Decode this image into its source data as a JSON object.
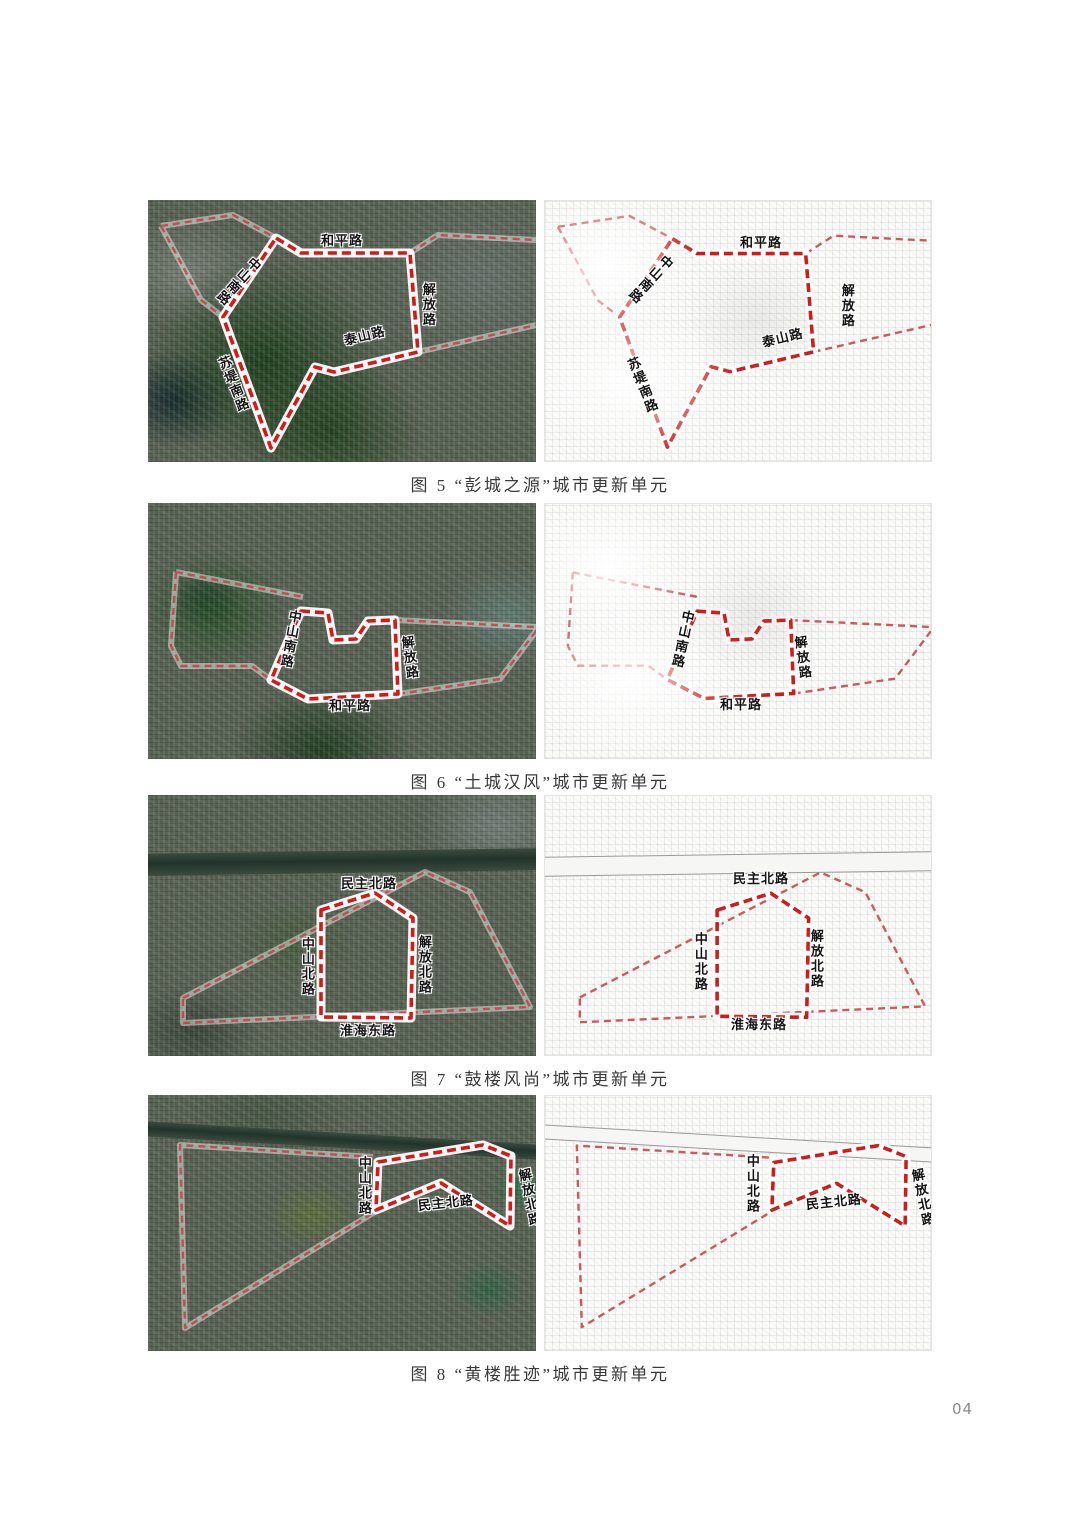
{
  "page": {
    "number": "04"
  },
  "style": {
    "unit_boundary_color": "#d51818",
    "outer_boundary_color": "#c24040",
    "road_label_color": "#141414"
  },
  "figures": [
    {
      "caption": "图 5 “彭城之源”城市更新单元",
      "unit_name": "彭城之源",
      "maps": [
        {
          "kind": "satellite",
          "roads": [
            "中山南路",
            "和平路",
            "解放路",
            "泰山路",
            "苏堤南路"
          ]
        },
        {
          "kind": "plan",
          "roads": [
            "中山南路",
            "和平路",
            "解放路",
            "泰山路",
            "苏堤南路"
          ]
        }
      ]
    },
    {
      "caption": "图 6 “土城汉风”城市更新单元",
      "unit_name": "土城汉风",
      "maps": [
        {
          "kind": "satellite",
          "roads": [
            "中山南路",
            "解放路",
            "和平路"
          ]
        },
        {
          "kind": "plan",
          "roads": [
            "中山南路",
            "解放路",
            "和平路"
          ]
        }
      ]
    },
    {
      "caption": "图 7 “鼓楼风尚”城市更新单元",
      "unit_name": "鼓楼风尚",
      "maps": [
        {
          "kind": "satellite",
          "roads": [
            "民主北路",
            "中山北路",
            "解放北路",
            "淮海东路"
          ]
        },
        {
          "kind": "plan",
          "roads": [
            "民主北路",
            "中山北路",
            "解放北路",
            "淮海东路"
          ]
        }
      ]
    },
    {
      "caption": "图 8 “黄楼胜迹”城市更新单元",
      "unit_name": "黄楼胜迹",
      "maps": [
        {
          "kind": "satellite",
          "roads": [
            "中山北路",
            "民主北路",
            "解放北路"
          ]
        },
        {
          "kind": "plan",
          "roads": [
            "中山北路",
            "民主北路",
            "解放北路"
          ]
        }
      ]
    }
  ]
}
